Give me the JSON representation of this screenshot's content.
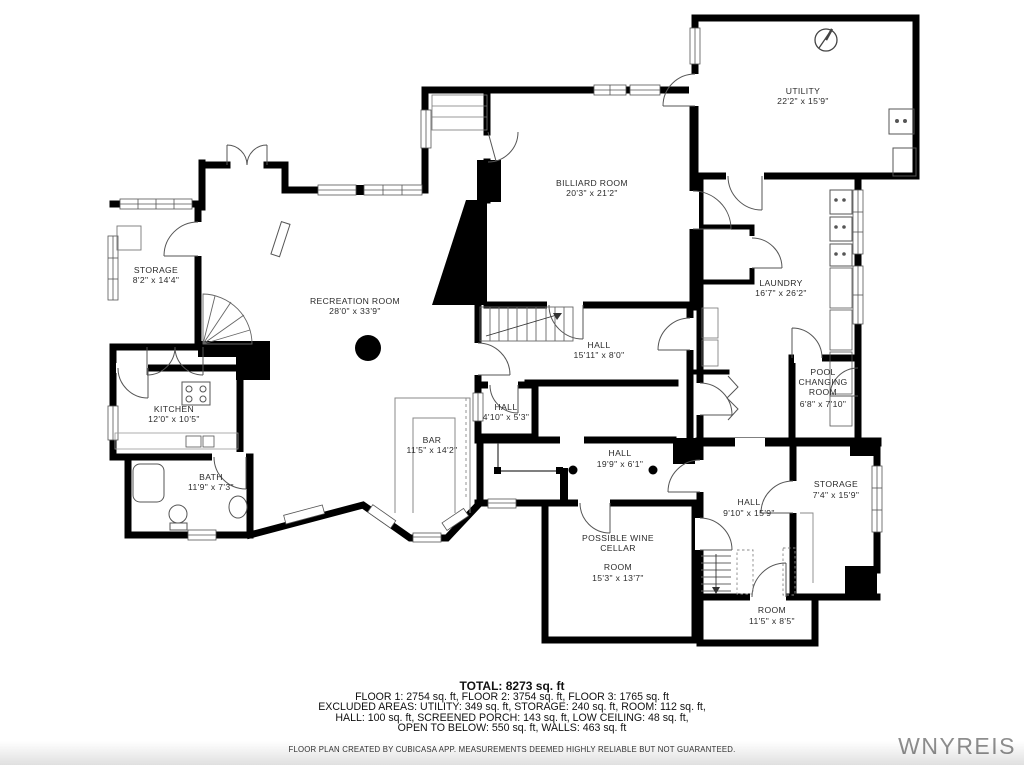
{
  "watermark": "WNYREIS",
  "rooms": {
    "utility": {
      "name": "UTILITY",
      "dims": "22'2\" x 15'9\""
    },
    "billiard": {
      "name": "BILLIARD ROOM",
      "dims": "20'3\" x 21'2\""
    },
    "storage_left": {
      "name": "STORAGE",
      "dims": "8'2\" x 14'4\""
    },
    "recreation": {
      "name": "RECREATION ROOM",
      "dims": "28'0\" x 33'9\""
    },
    "laundry": {
      "name": "LAUNDRY",
      "dims": "16'7\" x 26'2\""
    },
    "hall_upper": {
      "name": "HALL",
      "dims": "15'11\" x 8'0\""
    },
    "hall_small": {
      "name": "HALL",
      "dims": "4'10\" x 5'3\""
    },
    "kitchen": {
      "name": "KITCHEN",
      "dims": "12'0\" x 10'5\""
    },
    "bar": {
      "name": "BAR",
      "dims": "11'5\" x 14'2\""
    },
    "hall_long": {
      "name": "HALL",
      "dims": "19'9\" x 6'1\""
    },
    "bath": {
      "name": "BATH",
      "dims": "11'9\" x 7'3\""
    },
    "pool_changing": {
      "line1": "POOL",
      "line2": "CHANGING",
      "line3": "ROOM",
      "dims": "6'8\" x 7'10\""
    },
    "storage_right": {
      "name": "STORAGE",
      "dims": "7'4\" x 15'9\""
    },
    "hall_right": {
      "name": "HALL",
      "dims": "9'10\" x 15'9\""
    },
    "wine_cellar": {
      "line1": "POSSIBLE WINE",
      "line2": "CELLAR",
      "line3": "ROOM",
      "dims": "15'3\" x 13'7\""
    },
    "room_small": {
      "name": "ROOM",
      "dims": "11'5\" x 8'5\""
    }
  },
  "summary": {
    "total": "TOTAL: 8273 sq. ft",
    "line2": "FLOOR 1: 2754 sq. ft, FLOOR 2: 3754 sq. ft, FLOOR 3: 1765 sq. ft",
    "line3": "EXCLUDED AREAS: UTILITY: 349 sq. ft, STORAGE: 240 sq. ft, ROOM: 112 sq. ft,",
    "line4": "HALL: 100 sq. ft, SCREENED PORCH: 143 sq. ft, LOW CEILING: 48 sq. ft,",
    "line5": "OPEN TO BELOW: 550 sq. ft, WALLS: 463 sq. ft",
    "disclaimer": "FLOOR PLAN CREATED BY CUBICASA APP. MEASUREMENTS DEEMED HIGHLY RELIABLE BUT NOT GUARANTEED."
  },
  "colors": {
    "wall": "#000000",
    "label": "#2b2b2b",
    "watermark": "#8e8e8e"
  }
}
